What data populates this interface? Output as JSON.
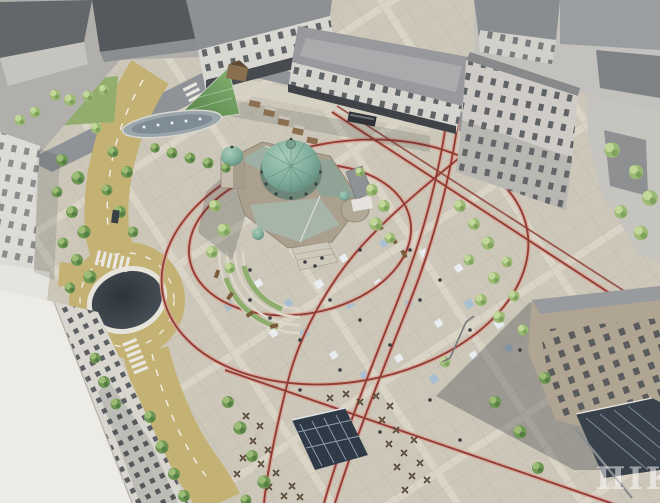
{
  "scene": {
    "kind": "aerial-architectural-render",
    "subject": "city-square-with-domed-church"
  },
  "watermark": {
    "text": "ПIК"
  },
  "palette": {
    "plaza": "#ccc7b9",
    "plaza_grid": "#bcb6a8",
    "road": "#c3b274",
    "asphalt": "#8f9296",
    "route_red": "#8f3b33",
    "route_halo": "#d8a294",
    "dome_teal": "#7fae9d",
    "roof_green": "#9db0a3",
    "tree_green": "#6f9754",
    "tree_light": "#9cba74",
    "building_light": "#d8d6d1",
    "roof_dark": "#5f6468",
    "glass_dark": "#39424c",
    "lawn": "#92ad6d"
  }
}
